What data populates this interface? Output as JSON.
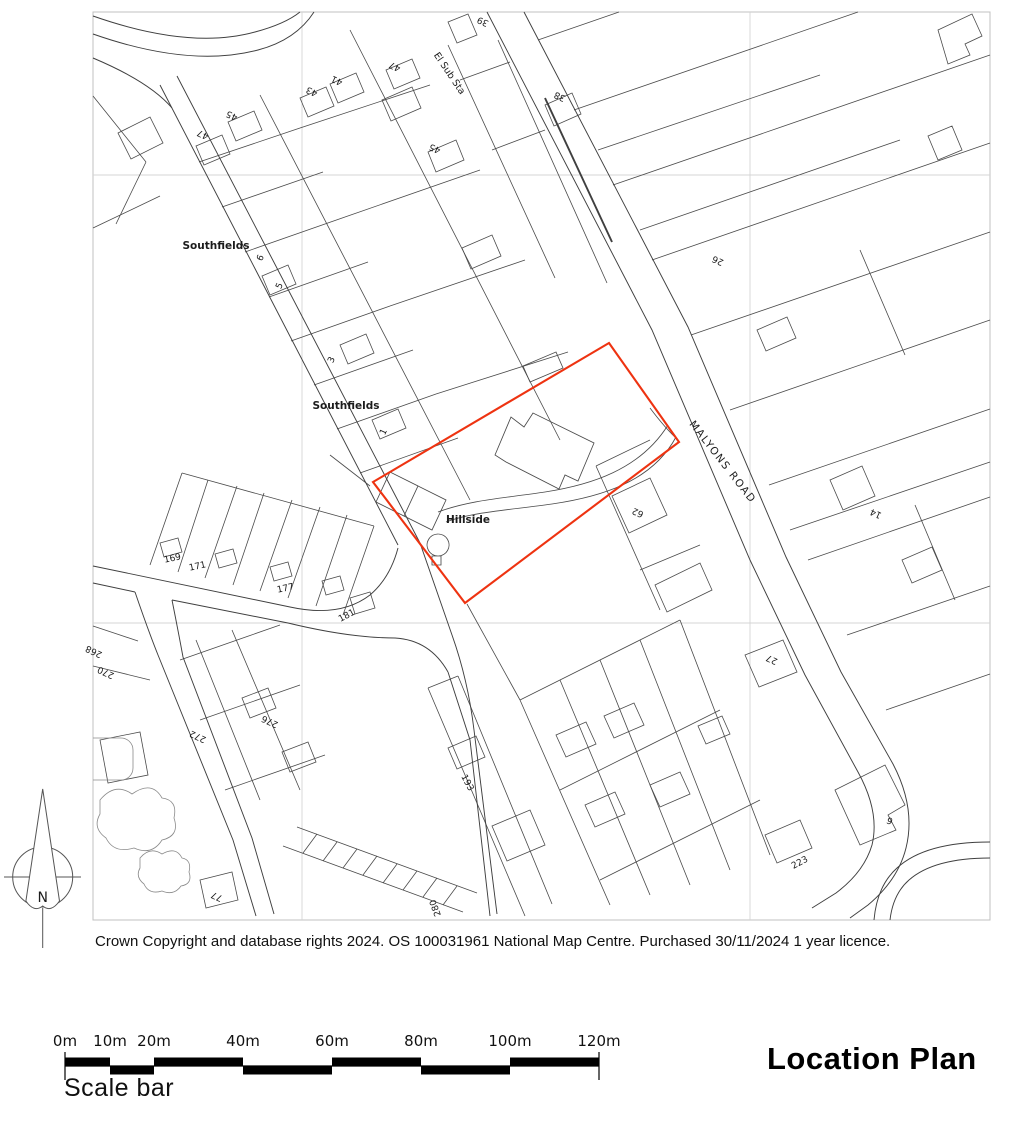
{
  "title": "Location Plan",
  "copyright": "Crown Copyright and database rights 2024. OS 100031961 National Map Centre. Purchased 30/11/2024 1 year licence.",
  "north_arrow": {
    "label": "N"
  },
  "scale_bar": {
    "labels": [
      "0m",
      "10m",
      "20m",
      "40m",
      "60m",
      "80m",
      "100m",
      "120m"
    ],
    "caption": "Scale bar"
  },
  "colors": {
    "ink": "#4a4a4a",
    "road_ink": "#3f3f3f",
    "grid": "#d4d4d4",
    "map_border": "#c0c0c0",
    "site_boundary": "#ee3311"
  },
  "map": {
    "labels": [
      {
        "text": "El Sub Sta",
        "x": 447,
        "y": 75,
        "rot": 56,
        "size": 9.5
      },
      {
        "text": "39",
        "x": 484,
        "y": 19,
        "rot": 205,
        "size": 9
      },
      {
        "text": "38",
        "x": 561,
        "y": 94,
        "rot": 205,
        "size": 9
      },
      {
        "text": "26",
        "x": 719,
        "y": 258,
        "rot": 205,
        "size": 9
      },
      {
        "text": "47",
        "x": 204,
        "y": 132,
        "rot": 205,
        "size": 9
      },
      {
        "text": "45",
        "x": 233,
        "y": 113,
        "rot": 205,
        "size": 9
      },
      {
        "text": "43",
        "x": 313,
        "y": 89,
        "rot": 205,
        "size": 9
      },
      {
        "text": "41",
        "x": 338,
        "y": 78,
        "rot": 205,
        "size": 9
      },
      {
        "text": "47",
        "x": 396,
        "y": 64,
        "rot": 205,
        "size": 9
      },
      {
        "text": "45",
        "x": 436,
        "y": 146,
        "rot": 205,
        "size": 9
      },
      {
        "text": "Southfields",
        "x": 216,
        "y": 249,
        "rot": 0,
        "size": 10.5,
        "bold": true
      },
      {
        "text": "6",
        "x": 263,
        "y": 259,
        "rot": 295,
        "size": 9
      },
      {
        "text": "5",
        "x": 282,
        "y": 287,
        "rot": 295,
        "size": 9
      },
      {
        "text": "3",
        "x": 334,
        "y": 361,
        "rot": 295,
        "size": 9
      },
      {
        "text": "Southfields",
        "x": 346,
        "y": 409,
        "rot": 0,
        "size": 10.5,
        "bold": true
      },
      {
        "text": "1",
        "x": 386,
        "y": 433,
        "rot": 295,
        "size": 9
      },
      {
        "text": "MALYONS ROAD",
        "x": 720,
        "y": 464,
        "rot": 52,
        "size": 10.5,
        "spacing": 1.5
      },
      {
        "text": "Hillside",
        "x": 468,
        "y": 523,
        "rot": 0,
        "size": 10.5,
        "bold": true
      },
      {
        "text": "62",
        "x": 639,
        "y": 510,
        "rot": 205,
        "size": 9
      },
      {
        "text": "14",
        "x": 877,
        "y": 511,
        "rot": 205,
        "size": 9
      },
      {
        "text": "169",
        "x": 173,
        "y": 561,
        "rot": -12,
        "size": 9
      },
      {
        "text": "171",
        "x": 198,
        "y": 569,
        "rot": -12,
        "size": 9
      },
      {
        "text": "177",
        "x": 286,
        "y": 591,
        "rot": -12,
        "size": 9
      },
      {
        "text": "181",
        "x": 348,
        "y": 618,
        "rot": -28,
        "size": 9
      },
      {
        "text": "268",
        "x": 95,
        "y": 649,
        "rot": 205,
        "size": 9
      },
      {
        "text": "270",
        "x": 107,
        "y": 670,
        "rot": 205,
        "size": 9
      },
      {
        "text": "272",
        "x": 199,
        "y": 734,
        "rot": 205,
        "size": 9
      },
      {
        "text": "276",
        "x": 271,
        "y": 719,
        "rot": 205,
        "size": 9
      },
      {
        "text": "27",
        "x": 773,
        "y": 657,
        "rot": 205,
        "size": 9
      },
      {
        "text": "193",
        "x": 465,
        "y": 784,
        "rot": 62,
        "size": 9
      },
      {
        "text": "6",
        "x": 891,
        "y": 818,
        "rot": 205,
        "size": 9
      },
      {
        "text": "223",
        "x": 801,
        "y": 865,
        "rot": -28,
        "size": 9
      },
      {
        "text": "77",
        "x": 218,
        "y": 894,
        "rot": 205,
        "size": 9
      },
      {
        "text": "280",
        "x": 438,
        "y": 907,
        "rot": 250,
        "size": 9
      }
    ]
  }
}
